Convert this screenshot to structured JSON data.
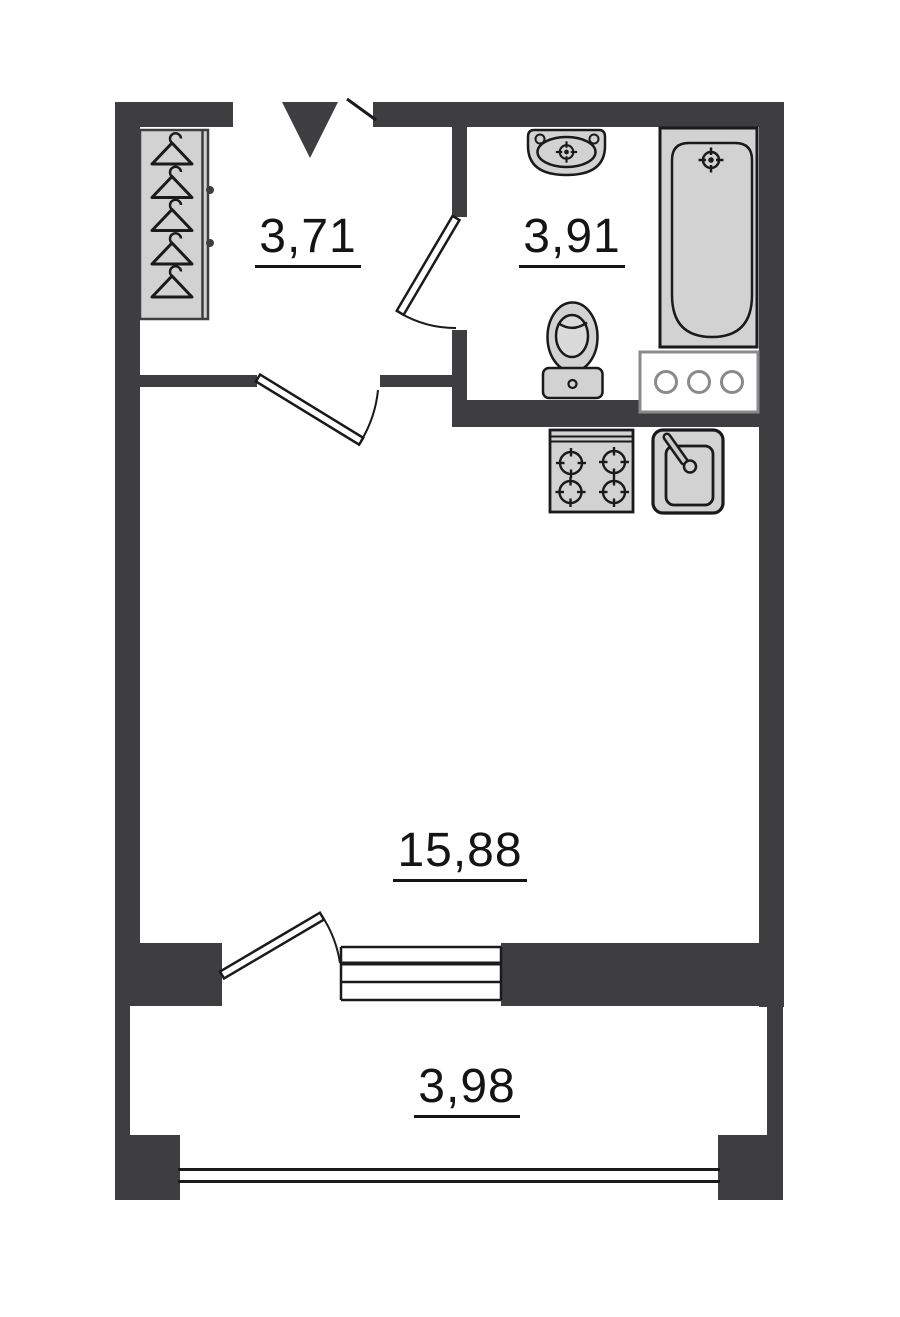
{
  "plan": {
    "type": "floor-plan",
    "rooms": [
      {
        "name": "hallway",
        "area_label": "3,71"
      },
      {
        "name": "bathroom",
        "area_label": "3,91"
      },
      {
        "name": "living-room",
        "area_label": "15,88"
      },
      {
        "name": "balcony",
        "area_label": "3,98"
      }
    ],
    "colors": {
      "wall": "#3E3E40",
      "fixture_fill": "#D2D2D2",
      "outline": "#1A1A1A",
      "appliance_outline": "#8A8A8A",
      "background": "#FFFFFF"
    },
    "icons": [
      "entrance-arrow-icon",
      "entrance-door-leaf",
      "wardrobe-icon",
      "hanger-icon",
      "interior-door-icon",
      "bathroom-sink-icon",
      "faucet-target-icon",
      "bathtub-icon",
      "toilet-icon",
      "washing-machine-icon",
      "stove-icon",
      "burner-icon",
      "kitchen-sink-icon",
      "window-icon",
      "balcony-glazing-icon"
    ]
  }
}
